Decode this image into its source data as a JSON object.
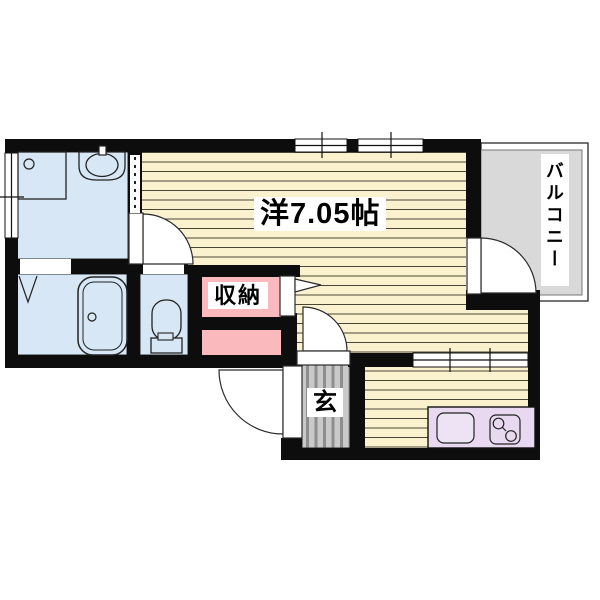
{
  "rooms": {
    "main_room": {
      "label": "洋7.05帖"
    },
    "storage": {
      "label": "収納"
    },
    "entrance": {
      "label": "玄"
    },
    "balcony": {
      "label": "バルコニー"
    }
  },
  "colors": {
    "wall": "#0d0d0d",
    "wood_floor": "#faf1cf",
    "wood_stripe": "#4a4636",
    "water_room_blue": "#d7e7f6",
    "storage_pink": "#f9b9bd",
    "entrance_gray": "#c9c9c9",
    "balcony_gray": "#d9d9d9",
    "kitchen_counter": "#e8d9f0",
    "background": "#ffffff"
  },
  "fixtures": [
    "washing-machine-pan",
    "washbasin",
    "bathtub",
    "toilet",
    "kitchen-sink",
    "two-burner-stove",
    "hinged-door-swing-washroom",
    "hinged-door-swing-main-room",
    "hinged-door-swing-entrance",
    "hinged-door-swing-balcony",
    "folding-closet-door",
    "sliding-window-top-left",
    "sliding-window-top-right",
    "sliding-window-left-wall",
    "sliding-window-kitchen",
    "accordion-door-dashed"
  ]
}
